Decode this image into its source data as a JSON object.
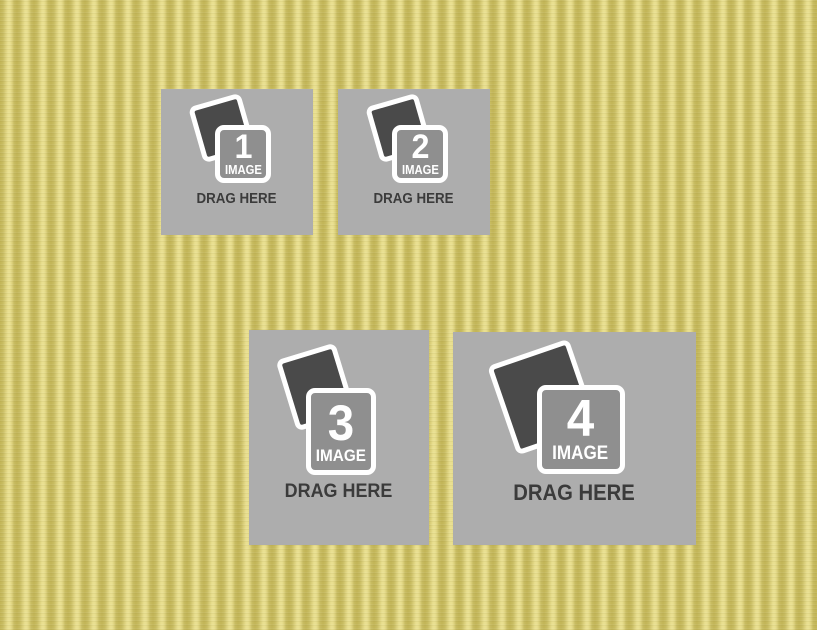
{
  "template": {
    "name": "four-image-collage-dropzones"
  },
  "colors": {
    "background_stripe_light": "#e9df90",
    "background_stripe_dark": "#c2b557",
    "dropzone_fill": "#adadad",
    "photo_back_fill": "#4a4a4a",
    "photo_front_fill": "#8f8f8f",
    "icon_border": "#ffffff",
    "icon_text": "#ffffff",
    "drag_label_text": "#3b3b3b"
  },
  "dropzones": [
    {
      "number": "1",
      "icon": "photo-stack-icon",
      "icon_label": "IMAGE",
      "drag_label": "DRAG HERE"
    },
    {
      "number": "2",
      "icon": "photo-stack-icon",
      "icon_label": "IMAGE",
      "drag_label": "DRAG HERE"
    },
    {
      "number": "3",
      "icon": "photo-stack-icon",
      "icon_label": "IMAGE",
      "drag_label": "DRAG HERE"
    },
    {
      "number": "4",
      "icon": "photo-stack-icon",
      "icon_label": "IMAGE",
      "drag_label": "DRAG HERE"
    }
  ]
}
